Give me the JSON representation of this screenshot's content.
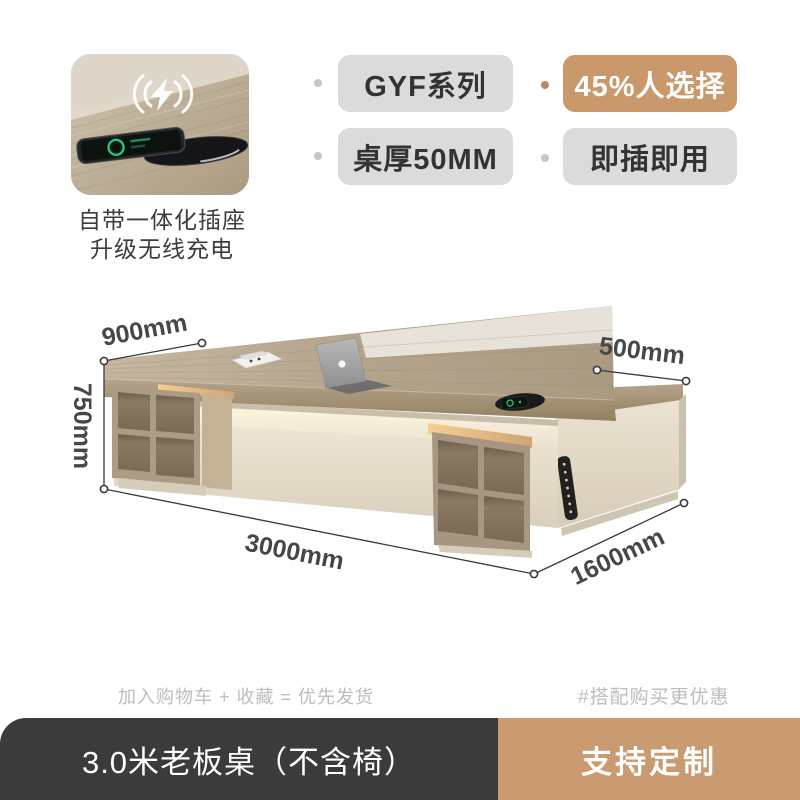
{
  "promo": {
    "icon": "wireless-charging-icon",
    "caption": [
      "自带一体化插座",
      "升级无线充电"
    ]
  },
  "badges": [
    {
      "label": "GYF系列",
      "style": "gray"
    },
    {
      "label": "45%人选择",
      "style": "tan"
    },
    {
      "label": "桌厚50MM",
      "style": "gray"
    },
    {
      "label": "即插即用",
      "style": "gray"
    }
  ],
  "diagram": {
    "labels": {
      "desk_depth": "900mm",
      "desk_height": "750mm",
      "desk_length": "3000mm",
      "return_depth": "500mm",
      "return_length": "1600mm"
    }
  },
  "notes": {
    "left": "加入购物车 + 收藏 = 优先发货",
    "right": "#搭配购买更优惠"
  },
  "bottom_bar": {
    "product_title": "3.0米老板桌（不含椅）",
    "action_label": "支持定制"
  },
  "colors": {
    "accent_tan": "#c9996c",
    "badge_gray": "#dbdbdb",
    "bar_dark": "#3b3b3b",
    "bar_tan": "#ca9b70",
    "muted_text": "#bdbdbd",
    "dim_text": "#474747"
  }
}
